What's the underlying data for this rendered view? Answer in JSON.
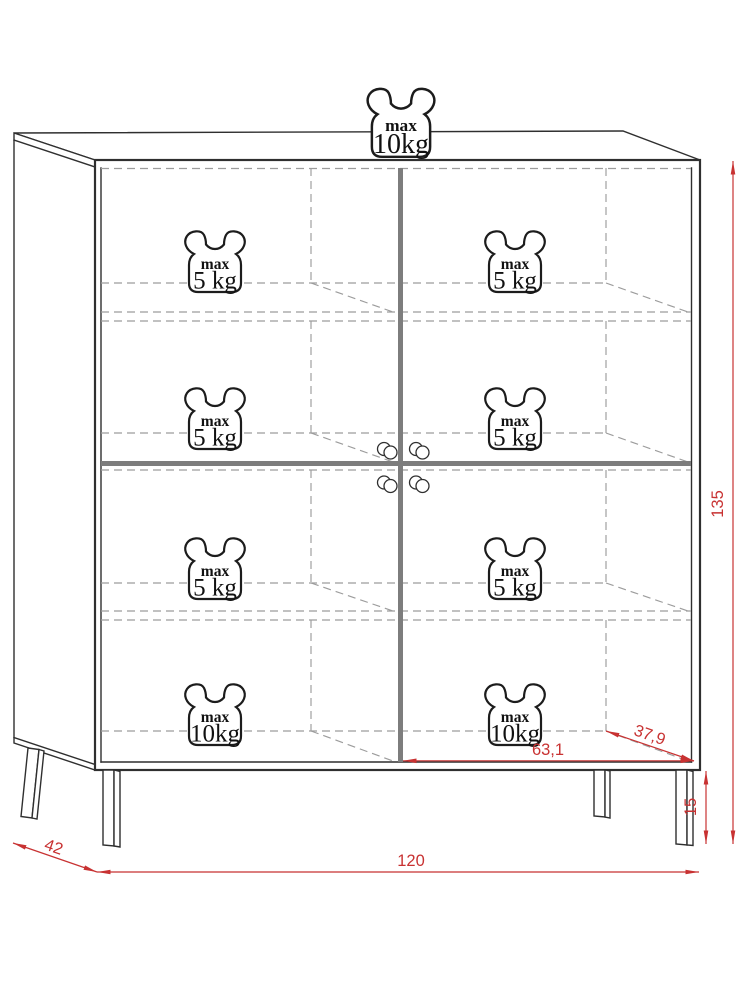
{
  "drawing": {
    "kind": "furniture dimension diagram",
    "subject": "four-door cabinet on legs, front-oblique view"
  },
  "dimensions": {
    "total_height": "135",
    "leg_height": "15",
    "width": "120",
    "depth": "42",
    "interior_width": "63,1",
    "interior_depth": "37,9"
  },
  "weight_icons": [
    {
      "id": "top",
      "prefix": "max",
      "value": "10kg"
    },
    {
      "id": "shelf1-left",
      "prefix": "max",
      "value": "5 kg"
    },
    {
      "id": "shelf1-right",
      "prefix": "max",
      "value": "5 kg"
    },
    {
      "id": "shelf2-left",
      "prefix": "max",
      "value": "5 kg"
    },
    {
      "id": "shelf2-right",
      "prefix": "max",
      "value": "5 kg"
    },
    {
      "id": "shelf3-left",
      "prefix": "max",
      "value": "5 kg"
    },
    {
      "id": "shelf3-right",
      "prefix": "max",
      "value": "5 kg"
    },
    {
      "id": "bottom-left",
      "prefix": "max",
      "value": "10kg"
    },
    {
      "id": "bottom-right",
      "prefix": "max",
      "value": "10kg"
    }
  ],
  "colors": {
    "dimension_red": "#c83232",
    "outline_dark": "#2f2f2f",
    "hidden_line_gray": "#9c9c9c",
    "door_gap_gray": "#7d7d7d"
  }
}
